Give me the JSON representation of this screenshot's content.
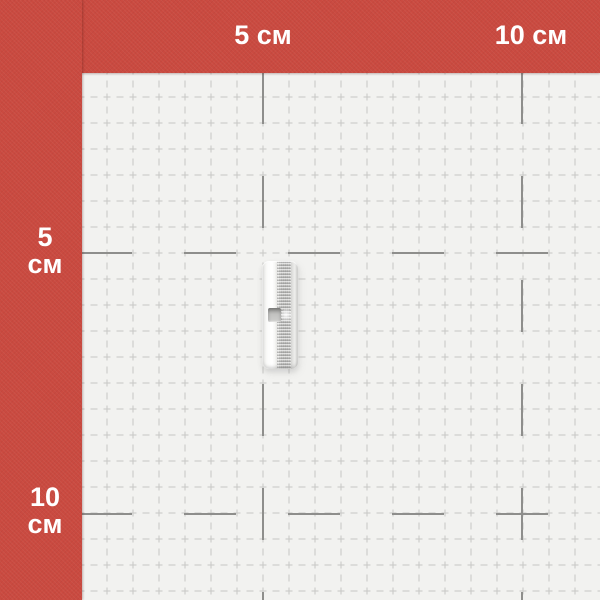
{
  "canvas": {
    "kind": "product-photo",
    "subject": "metal-butt-connector-sleeve-on-measuring-grid"
  },
  "ruler": {
    "unit": "см",
    "top_ticks": [
      {
        "label": "5 см"
      },
      {
        "label": "10 см"
      }
    ],
    "left_ticks": [
      {
        "value": "5",
        "unit": "см"
      },
      {
        "value": "10",
        "unit": "см"
      }
    ]
  },
  "colors": {
    "frame_red": "#ca4a40",
    "paper": "#f2f2f0",
    "grid_minor": "#c7c7c5",
    "grid_major": "#8e8e8c",
    "label_text": "#ffffff"
  }
}
